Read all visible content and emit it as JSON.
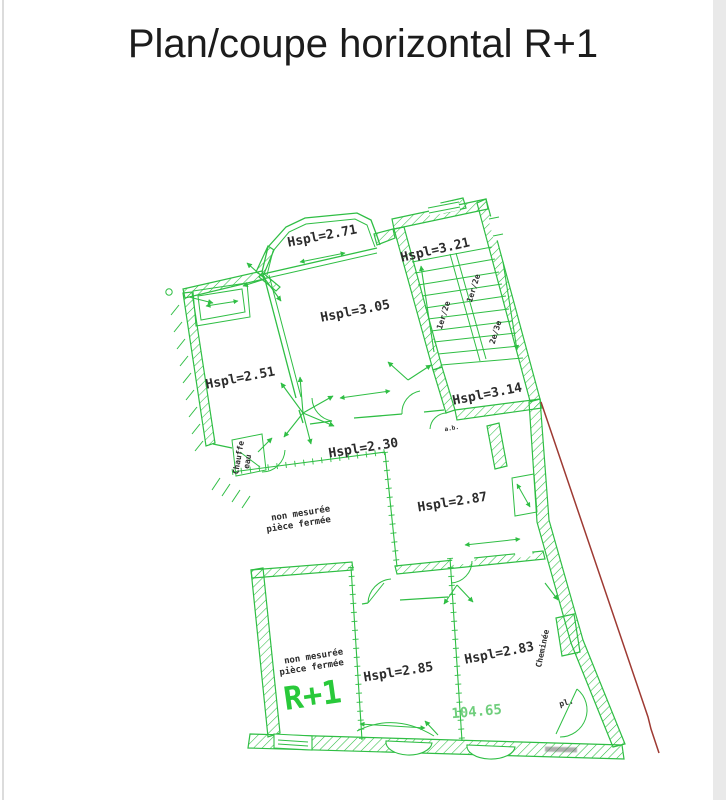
{
  "labels": {
    "title": "Plan/coupe horizontal R+1",
    "hspl271": "Hspl=2.71",
    "hspl321": "Hspl=3.21",
    "hspl305": "Hspl=3.05",
    "hspl251": "Hspl=2.51",
    "hspl314": "Hspl=3.14",
    "hspl230": "Hspl=2.30",
    "hspl287": "Hspl=2.87",
    "hspl285": "Hspl=2.85",
    "hspl283": "Hspl=2.83",
    "unmeasured_line1": "non mesurée",
    "unmeasured_line2": "pièce fermée",
    "floor_marker": "R+1",
    "area_value": "104.65",
    "chimney": "Cheminée",
    "water_heater_line1": "Chauffe",
    "water_heater_line2": "eau",
    "closet": "pl.",
    "tiny_note": "a.b.",
    "stair_flight_1": "1er/2e",
    "stair_flight_2": "1er/2e",
    "stair_flight_3": "2e/3e"
  },
  "colors": {
    "drawing_green": "#2fbe44",
    "accent_green": "#29c93a",
    "area_green": "#6fce7c",
    "boundary_red": "#9e3a33",
    "label_dark": "#2b2b2b",
    "title_black": "#1c1c1c"
  }
}
